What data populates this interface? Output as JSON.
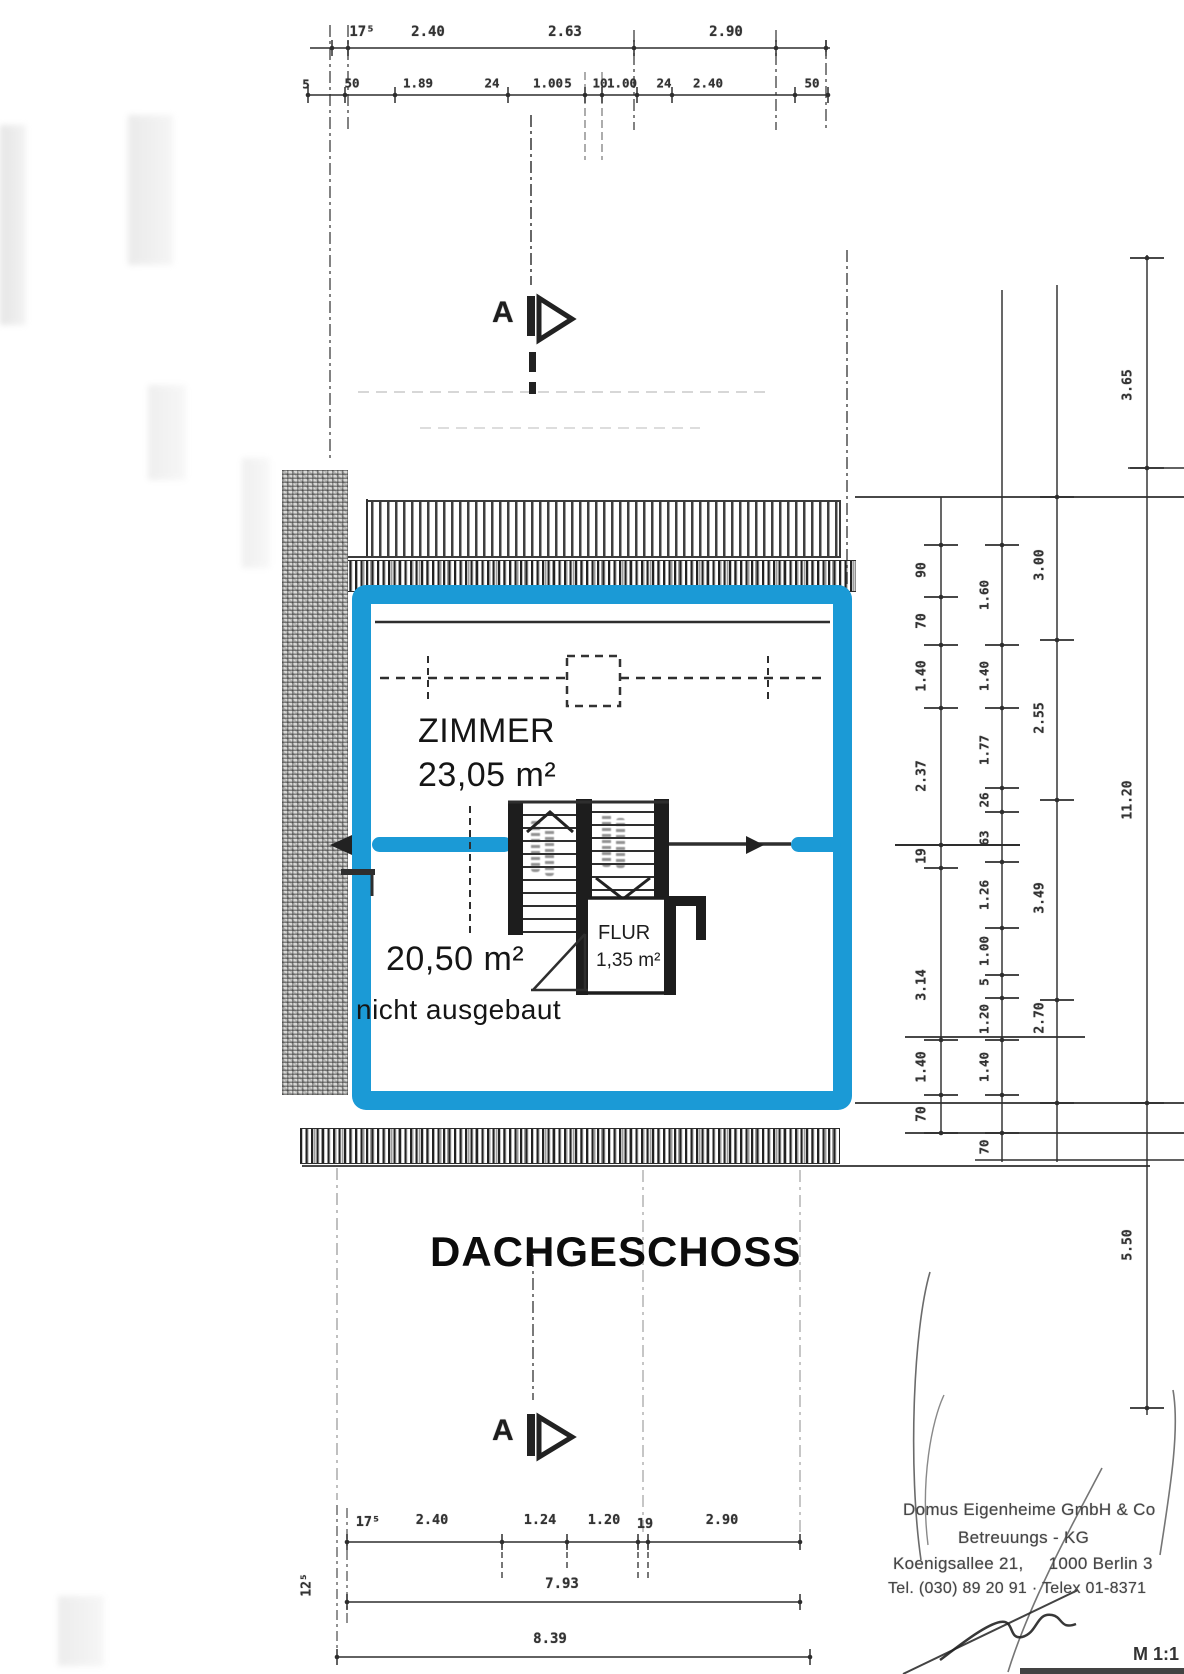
{
  "page": {
    "floor_title": "DACHGESCHOSS",
    "scale_label": "M 1:1",
    "section_marker_letter": "A"
  },
  "rooms": {
    "zimmer": {
      "name": "ZIMMER",
      "area": "23,05 m²"
    },
    "attic_open": {
      "area": "20,50 m²",
      "note": "nicht ausgebaut"
    },
    "flur": {
      "name": "FLUR",
      "area": "1,35 m²"
    }
  },
  "stamp": {
    "line1": "Domus Eigenheime GmbH & Co",
    "line2": "Betreuungs - KG",
    "line3": "Koenigsallee 21,     1000 Berlin 3",
    "line4": "Tel. (030) 89 20 91 · Telex 01-8371"
  },
  "dimensions": {
    "top_row1": [
      "17⁵",
      "2.40",
      "2.63",
      "2.90"
    ],
    "top_row2": [
      "5",
      "50",
      "1.89",
      "24",
      "1.00",
      "5",
      "10",
      "1.00",
      "24",
      "2.40",
      "50"
    ],
    "right_chain_inner": [
      "90",
      "70",
      "1.40",
      "2.37",
      "19",
      "3.14",
      "1.40",
      "70"
    ],
    "right_chain_middle": [
      "1.60",
      "1.40",
      "1.77",
      "26",
      "63",
      "1.26",
      "1.00",
      "5",
      "1.20",
      "1.40",
      "70"
    ],
    "right_chain_outer": [
      "3.00",
      "2.55",
      "3.49",
      "2.70"
    ],
    "right_chain_total": [
      "3.65",
      "11.20",
      "5.50"
    ],
    "bottom_row1": [
      "17⁵",
      "2.40",
      "1.24",
      "1.20",
      "19",
      "2.90"
    ],
    "bottom_total_1": "7.93",
    "bottom_total_2": "8.39",
    "bottom_left_side": "12⁵"
  },
  "colors": {
    "highlight_blue": "#1b9ad6",
    "ink": "#2e2e2e"
  }
}
